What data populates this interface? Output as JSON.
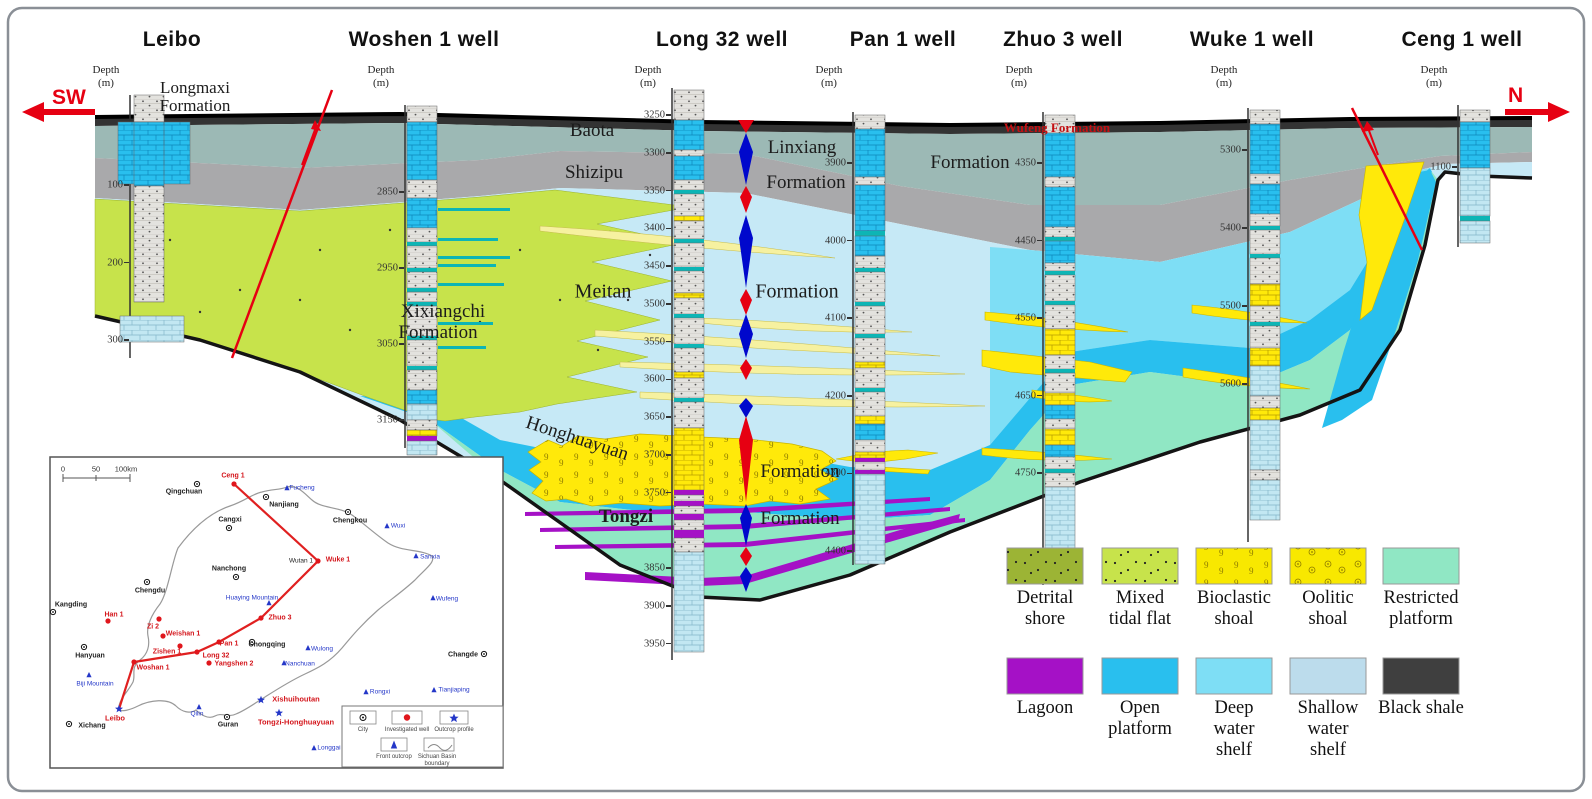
{
  "title_area": {
    "sw_label": "SW",
    "n_label": "N"
  },
  "wells": [
    {
      "name": "Leibo",
      "depth_label": "Depth",
      "unit": "(m)",
      "ticks": [
        100,
        200,
        300
      ]
    },
    {
      "name": "Woshen 1 well",
      "depth_label": "Depth",
      "unit": "(m)",
      "ticks": [
        2850,
        2950,
        3050,
        3150
      ]
    },
    {
      "name": "Long 32 well",
      "depth_label": "Depth",
      "unit": "(m)",
      "ticks": [
        3250,
        3300,
        3350,
        3400,
        3450,
        3500,
        3550,
        3600,
        3650,
        3700,
        3750,
        3850,
        3900,
        3950
      ]
    },
    {
      "name": "Pan 1 well",
      "depth_label": "Depth",
      "unit": "(m)",
      "ticks": [
        3900,
        4000,
        4100,
        4200,
        4300,
        4400
      ]
    },
    {
      "name": "Zhuo 3 well",
      "depth_label": "Depth",
      "unit": "(m)",
      "ticks": [
        4350,
        4450,
        4550,
        4650,
        4750
      ]
    },
    {
      "name": "Wuke 1 well",
      "depth_label": "Depth",
      "unit": "(m)",
      "ticks": [
        5300,
        5400,
        5500,
        5600
      ]
    },
    {
      "name": "Ceng 1 well",
      "depth_label": "Depth",
      "unit": "(m)",
      "ticks": [
        1100
      ]
    }
  ],
  "formations": {
    "longmaxi": [
      "Longmaxi",
      "Formation"
    ],
    "xixiangchi": [
      "Xixiangchi",
      "Formation"
    ],
    "baota": "Baota",
    "baota_formation": "Formation",
    "shizipu": "Shizipu",
    "linxiang": "Linxiang",
    "linxiang_formation": "Formation",
    "wufeng": "Wufeng Formation",
    "meitan": "Meitan",
    "meitan_formation": "Formation",
    "honghuayuan": "Honghuayuan",
    "honghuayuan_formation": "Formation",
    "tongzi": "Tongzi",
    "tongzi_formation": "Formation"
  },
  "legend": {
    "rows": [
      {
        "items": [
          {
            "key": "detrital-shore",
            "lines": [
              "Detrital",
              "shore"
            ],
            "color": "#9cb435"
          },
          {
            "key": "mixed-tidal-flat",
            "lines": [
              "Mixed",
              "tidal flat"
            ],
            "color": "#c7e34b"
          },
          {
            "key": "bioclastic-shoal",
            "lines": [
              "Bioclastic",
              "shoal"
            ],
            "color": "#f8e800"
          },
          {
            "key": "oolitic-shoal",
            "lines": [
              "Oolitic",
              "shoal"
            ],
            "color": "#f8e800"
          },
          {
            "key": "restricted-platform",
            "lines": [
              "Restricted",
              "platform"
            ],
            "color": "#90e7c4"
          }
        ]
      },
      {
        "items": [
          {
            "key": "lagoon",
            "lines": [
              "Lagoon"
            ],
            "color": "#a511c6"
          },
          {
            "key": "open-platform",
            "lines": [
              "Open",
              "platform"
            ],
            "color": "#29bfee"
          },
          {
            "key": "deep-water-shelf",
            "lines": [
              "Deep",
              "water",
              "shelf"
            ],
            "color": "#7edef5"
          },
          {
            "key": "shallow-water-shelf",
            "lines": [
              "Shallow",
              "water",
              "shelf"
            ],
            "color": "#bcdcec"
          },
          {
            "key": "black-shale",
            "lines": [
              "Black shale"
            ],
            "color": "#3f3f3f"
          }
        ]
      }
    ]
  },
  "map": {
    "scale_labels": [
      "0",
      "50",
      "100km"
    ],
    "section_line": [
      [
        119,
        709
      ],
      [
        134,
        662
      ],
      [
        197,
        652
      ],
      [
        219,
        642
      ],
      [
        261,
        618
      ],
      [
        318,
        561
      ],
      [
        234,
        484
      ]
    ],
    "points": [
      {
        "label": "Qingchuan",
        "type": "city",
        "x": 197,
        "y": 484,
        "lx": 184,
        "ly": 492
      },
      {
        "label": "Nanjiang",
        "type": "city",
        "x": 266,
        "y": 497,
        "lx": 284,
        "ly": 505
      },
      {
        "label": "Chengkou",
        "type": "city",
        "x": 348,
        "y": 512,
        "lx": 350,
        "ly": 521
      },
      {
        "label": "Cangxi",
        "type": "city",
        "x": 229,
        "y": 528,
        "lx": 230,
        "ly": 520
      },
      {
        "label": "Nanchong",
        "type": "city",
        "x": 236,
        "y": 577,
        "lx": 229,
        "ly": 569
      },
      {
        "label": "Chengdu",
        "type": "city",
        "x": 147,
        "y": 582,
        "lx": 150,
        "ly": 591
      },
      {
        "label": "Kangding",
        "type": "city",
        "x": 53,
        "y": 612,
        "lx": 71,
        "ly": 605
      },
      {
        "label": "Hanyuan",
        "type": "city",
        "x": 84,
        "y": 647,
        "lx": 90,
        "ly": 656
      },
      {
        "label": "Xichang",
        "type": "city",
        "x": 69,
        "y": 724,
        "lx": 92,
        "ly": 726
      },
      {
        "label": "Guran",
        "type": "city",
        "x": 227,
        "y": 717,
        "lx": 228,
        "ly": 725
      },
      {
        "label": "Chongqing",
        "type": "city",
        "x": 252,
        "y": 642,
        "lx": 267,
        "ly": 645
      },
      {
        "label": "Changde",
        "type": "city",
        "x": 484,
        "y": 654,
        "lx": 463,
        "ly": 655
      },
      {
        "label": "Ceng 1",
        "type": "well",
        "x": 234,
        "y": 484,
        "lx": 233,
        "ly": 476
      },
      {
        "label": "Wuke 1",
        "type": "well",
        "x": 318,
        "y": 561,
        "lx": 338,
        "ly": 560
      },
      {
        "label": "Han 1",
        "type": "well",
        "x": 108,
        "y": 621,
        "lx": 114,
        "ly": 615
      },
      {
        "label": "Zi 2",
        "type": "well",
        "x": 159,
        "y": 619,
        "lx": 153,
        "ly": 627
      },
      {
        "label": "Weishan 1",
        "type": "well",
        "x": 163,
        "y": 636,
        "lx": 183,
        "ly": 634
      },
      {
        "label": "Zishen 1",
        "type": "well",
        "x": 180,
        "y": 646,
        "lx": 167,
        "ly": 652
      },
      {
        "label": "Pan 1",
        "type": "well",
        "x": 219,
        "y": 642,
        "lx": 229,
        "ly": 644
      },
      {
        "label": "Long 32",
        "type": "well",
        "x": 197,
        "y": 652,
        "lx": 216,
        "ly": 656
      },
      {
        "label": "Yangshen 2",
        "type": "well",
        "x": 209,
        "y": 663,
        "lx": 234,
        "ly": 664
      },
      {
        "label": "Zhuo 3",
        "type": "well",
        "x": 261,
        "y": 618,
        "lx": 280,
        "ly": 618
      },
      {
        "label": "Woshan 1",
        "type": "well",
        "x": 134,
        "y": 662,
        "lx": 153,
        "ly": 668
      },
      {
        "label": "Leibo",
        "type": "star",
        "x": 119,
        "y": 709,
        "lx": 115,
        "ly": 718
      },
      {
        "label": "Xishuihoutan",
        "type": "star",
        "x": 261,
        "y": 700,
        "lx": 296,
        "ly": 699
      },
      {
        "label": "Tongzi-Honghuayuan",
        "type": "star",
        "x": 279,
        "y": 713,
        "lx": 296,
        "ly": 722
      },
      {
        "label": "Fucheng",
        "type": "front",
        "x": 287,
        "y": 488,
        "lx": 302,
        "ly": 488
      },
      {
        "label": "Wuxi",
        "type": "front",
        "x": 387,
        "y": 526,
        "lx": 398,
        "ly": 526
      },
      {
        "label": "Sanxia",
        "type": "front",
        "x": 416,
        "y": 556,
        "lx": 430,
        "ly": 557
      },
      {
        "label": "Wufeng",
        "type": "front",
        "x": 433,
        "y": 598,
        "lx": 447,
        "ly": 599
      },
      {
        "label": "Wulong",
        "type": "front",
        "x": 308,
        "y": 648,
        "lx": 322,
        "ly": 649
      },
      {
        "label": "Nanchuan",
        "type": "front",
        "x": 284,
        "y": 663,
        "lx": 300,
        "ly": 664
      },
      {
        "label": "Huaying Mountain",
        "type": "front",
        "x": 269,
        "y": 603,
        "lx": 252,
        "ly": 598
      },
      {
        "label": "Biji Mountain",
        "type": "front",
        "x": 89,
        "y": 675,
        "lx": 95,
        "ly": 684
      },
      {
        "label": "Qilin",
        "type": "front",
        "x": 199,
        "y": 707,
        "lx": 197,
        "ly": 714
      },
      {
        "label": "Rongxi",
        "type": "front",
        "x": 366,
        "y": 692,
        "lx": 380,
        "ly": 692
      },
      {
        "label": "Tianjiaping",
        "type": "front",
        "x": 434,
        "y": 690,
        "lx": 454,
        "ly": 690
      },
      {
        "label": "Longgai",
        "type": "front",
        "x": 314,
        "y": 748,
        "lx": 329,
        "ly": 748
      },
      {
        "label": "Wutan 1",
        "type": "plain",
        "x": 0,
        "y": 0,
        "lx": 301,
        "ly": 561
      }
    ],
    "legend": {
      "items": [
        {
          "symbol": "city",
          "label": "City"
        },
        {
          "symbol": "well",
          "label": "Investigated well"
        },
        {
          "symbol": "outcrop",
          "label": "Outcrop profile"
        },
        {
          "symbol": "front",
          "label": "Front outcrop"
        },
        {
          "symbol": "boundary",
          "label": "Sichuan Basin boundary"
        }
      ]
    }
  },
  "palette": {
    "accent_red": "#e60012",
    "sea_level_blue": "#0008cc",
    "shale_band": "#333333",
    "baota_linxiang_band": "#9cb9b5",
    "shizipu_band": "#a9a9ab",
    "shallow_shelf_fill": "#c6e9f6",
    "deep_shelf_fill": "#7edef5",
    "open_platform_fill": "#29bfee",
    "restricted_fill": "#90e7c4",
    "tidal_flat_fill": "#c7e34b",
    "shoal_yellow": "#ffe90a",
    "lens_yellow": "#f6f1a0",
    "lagoon_purple": "#a511c6"
  }
}
